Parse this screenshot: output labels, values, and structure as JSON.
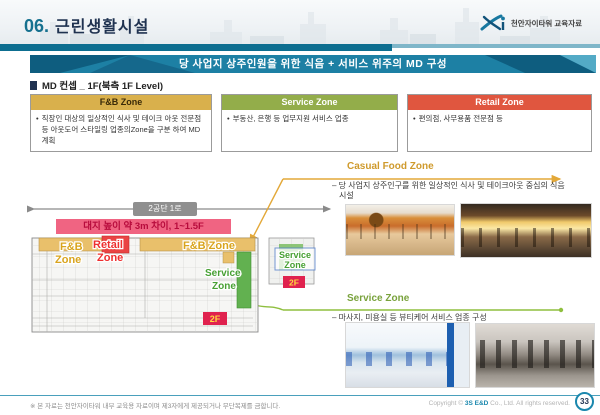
{
  "header": {
    "section_no": "06.",
    "title": "근린생활시설",
    "logo_caption": "천안자이타워 교육자료"
  },
  "banner": {
    "text": "당 사업지 상주인원을 위한 식음 + 서비스 위주의 MD 구성"
  },
  "concept_label": "MD 컨셉 _ 1F(북측 1F Level)",
  "md_zones": [
    {
      "title": "F&B Zone",
      "bullet": "직장인 대상의 일상적인 식사 및 테이크 아웃 전문점 등 아웃도어 스타일링 업종의Zone을 구분 하여 MD계획"
    },
    {
      "title": "Service Zone",
      "bullet": "부동산, 은행 등 업무지원 서비스 업종"
    },
    {
      "title": "Retail Zone",
      "bullet": "편의점, 사무용품 전문점 등"
    }
  ],
  "plan": {
    "street_label": "2공단 1로",
    "height_note": "대지 높이 약 3m 차이, 1~1.5F",
    "fnb_left": {
      "line1": "F&B",
      "line2": "Zone"
    },
    "retail": {
      "line1": "Retail",
      "line2": "Zone"
    },
    "fnb_right": "F&B Zone",
    "service_main": {
      "line1": "Service",
      "line2": "Zone"
    },
    "service_annex": {
      "line1": "Service",
      "line2": "Zone"
    },
    "floor_badge": "2F"
  },
  "detail_sections": [
    {
      "title": "Casual Food Zone",
      "desc": "– 당 사업지 상주인구를 위한 일상적인 식사 및 테이크아웃 중심의 식음 시설"
    },
    {
      "title": "Service Zone",
      "desc": "– 마사지, 미용실 등 뷰티케어 서비스 업종 구성"
    }
  ],
  "footer": {
    "disclaimer": "※ 본 자료는 천안자이타워 내부 교육용 자료이며 제3자에게 제공되거나 무단복제를 금합니다.",
    "copyright_prefix": "Copyright © ",
    "company": "3S E&D",
    "copyright_suffix": " Co., Ltd. All rights reserved.",
    "page_number": "33"
  },
  "colors": {
    "accent_teal": "#0d6e90",
    "gold": "#d9a41d",
    "olive": "#93ad4a",
    "red": "#e0563f",
    "pink": "#f06482",
    "green": "#5fae4a"
  }
}
